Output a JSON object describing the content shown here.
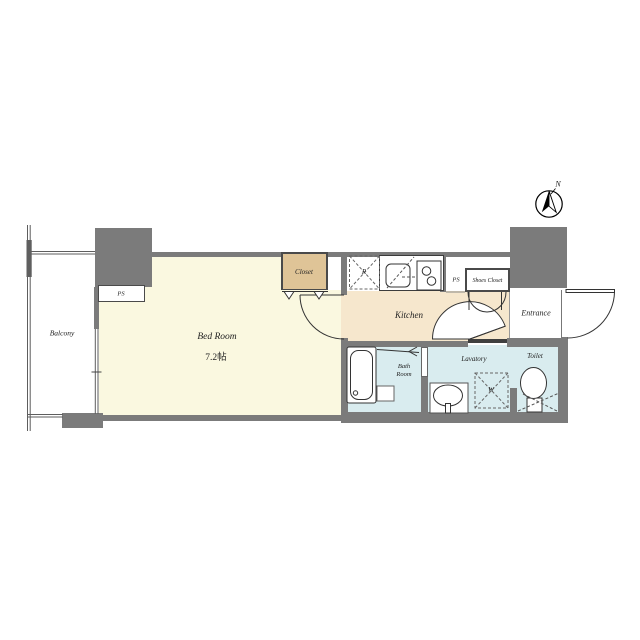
{
  "document": {
    "type": "apartment-floor-plan"
  },
  "compass": {
    "north_label": "N"
  },
  "rooms": {
    "balcony": {
      "label": "Balcony"
    },
    "bedroom": {
      "label": "Bed Room",
      "size": "7.2帖"
    },
    "closet": {
      "label": "Closet"
    },
    "kitchen": {
      "label": "Kitchen"
    },
    "ps_left": {
      "label": "PS"
    },
    "ps_right": {
      "label": "PS"
    },
    "shoes_closet": {
      "label": "Shoes Closet"
    },
    "entrance": {
      "label": "Entrance"
    },
    "bath": {
      "label": "Bath Room"
    },
    "lavatory": {
      "label": "Lavatory"
    },
    "toilet": {
      "label": "Toilet"
    }
  },
  "fixtures": {
    "refrigerator_label": "R",
    "washer_label": "W"
  },
  "colors": {
    "wall_gray": "#7b7b7b",
    "sill_dark": "#3f3f3f",
    "bedroom_cream": "#faf8e0",
    "kitchen_tan": "#f6e7cd",
    "closet_tan": "#dfc497",
    "wet_blue": "#d9ecef",
    "line": "#333333"
  }
}
